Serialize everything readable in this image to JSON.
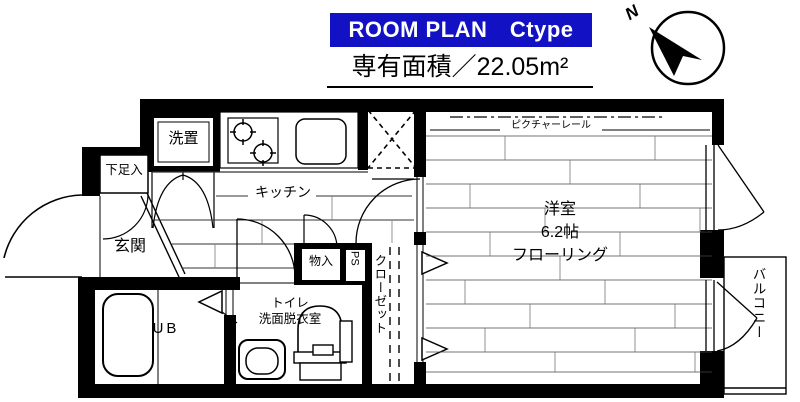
{
  "header": {
    "plan_type": "ROOM PLAN　Ctype",
    "area_label": "専有面積／22.05m²"
  },
  "compass": {
    "north": "N"
  },
  "labels": {
    "entrance": "玄関",
    "shoe_box": "下足入",
    "washer_place": "洗置",
    "kitchen": "キッチン",
    "room_name": "洋室",
    "room_size": "6.2帖",
    "room_floor": "フローリング",
    "picture_rail": "ピクチャーレール",
    "unit_bath": "UB",
    "toilet": "トイレ",
    "washroom": "洗面脱衣室",
    "storage": "物入",
    "pipe_space": "PS",
    "closet": "クローゼット",
    "balcony": "バルコニー"
  },
  "colors": {
    "title_bg": "#1212c4",
    "title_text": "#ffffff",
    "plan_line": "#000000"
  }
}
